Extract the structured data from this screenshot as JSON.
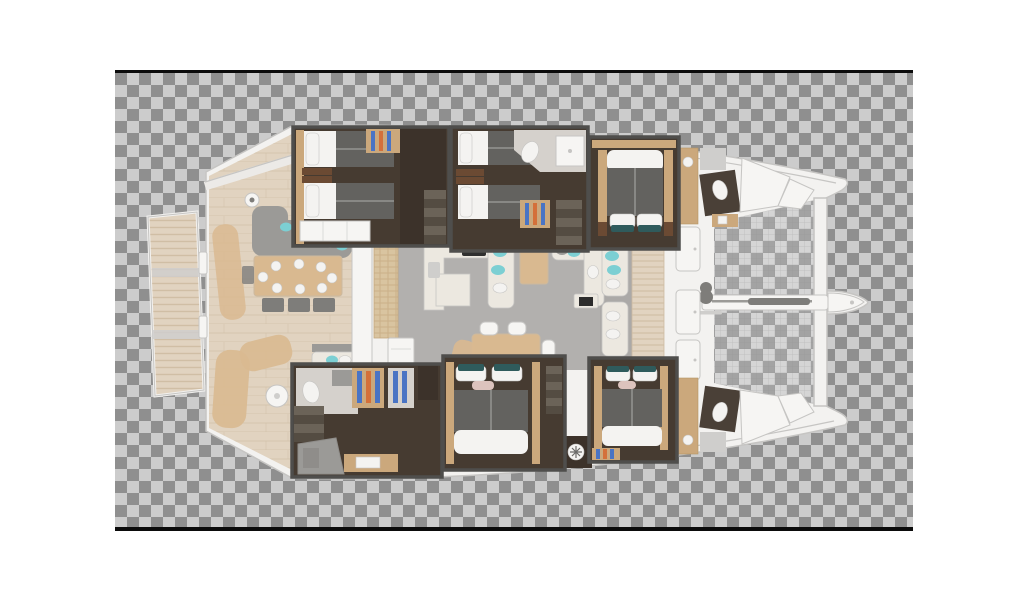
{
  "page": {
    "background": "#ffffff"
  },
  "canvas": {
    "width": 1024,
    "height": 600,
    "artwork_area": {
      "x": 115,
      "y": 70,
      "width": 798,
      "height": 462
    }
  },
  "colors": {
    "page": "#ffffff",
    "checker-light": "#cccccc",
    "checker-dark": "#8f8f8f",
    "frame-black": "#0b0b0b",
    "hull": "#f3f2f0",
    "hull-stroke": "#c6c5c3",
    "white": "#f6f5f3",
    "deck-wood": "#e1d3c0",
    "wood-line": "#ccb99f",
    "saloon-floor": "#b2b0ae",
    "sofa-cream": "#ece8e0",
    "teal": "#7ccfd3",
    "teal-dark": "#2f5b5c",
    "ext-sofa": "#9b9a97",
    "table-wood": "#d9b990",
    "stool": "#7e7d7a",
    "cabin-floor": "#463b31",
    "corridor": "#3c322a",
    "inset-border": "#4f4e4c",
    "duvet": "#63625f",
    "sheet": "#f4f3f1",
    "wood-trim": "#cba87c",
    "nightstand": "#6b4a33",
    "hanger-blue": "#4a74c4",
    "hanger-orange": "#d4703a",
    "bath-floor": "#d5d1cc",
    "dark-bath": "#4a4037",
    "rose": "#dcc3bd",
    "stair-1": "#6b6358",
    "stair-2": "#544c42",
    "seam": "#cfcecc",
    "mesh-line": "#8a8a8a",
    "rattan": "#d9c4a0",
    "rattan-line": "#c3a87e"
  },
  "floorplan": {
    "type": "catamaran-yacht-deck-plan",
    "orientation": "bow-right",
    "background_style": "transparency-checkerboard",
    "regions": [
      "swim-platform",
      "aft-deck",
      "aft-cockpit-sofa",
      "aft-cockpit-dining-table",
      "saloon",
      "galley",
      "saloon-sofa",
      "saloon-dining-table",
      "forward-cockpit",
      "rattan-sunpad",
      "foredeck-walkway",
      "trampoline",
      "forward-beam",
      "bowsprit",
      "starboard-aft-cabin",
      "starboard-mid-cabin",
      "starboard-forward-cabin",
      "port-aft-bathroom",
      "port-mid-cabin",
      "port-forward-cabin",
      "starboard-bow-bathroom",
      "port-bow-bathroom"
    ],
    "cabin_inset_count": 6,
    "dining_place_settings": 8
  }
}
